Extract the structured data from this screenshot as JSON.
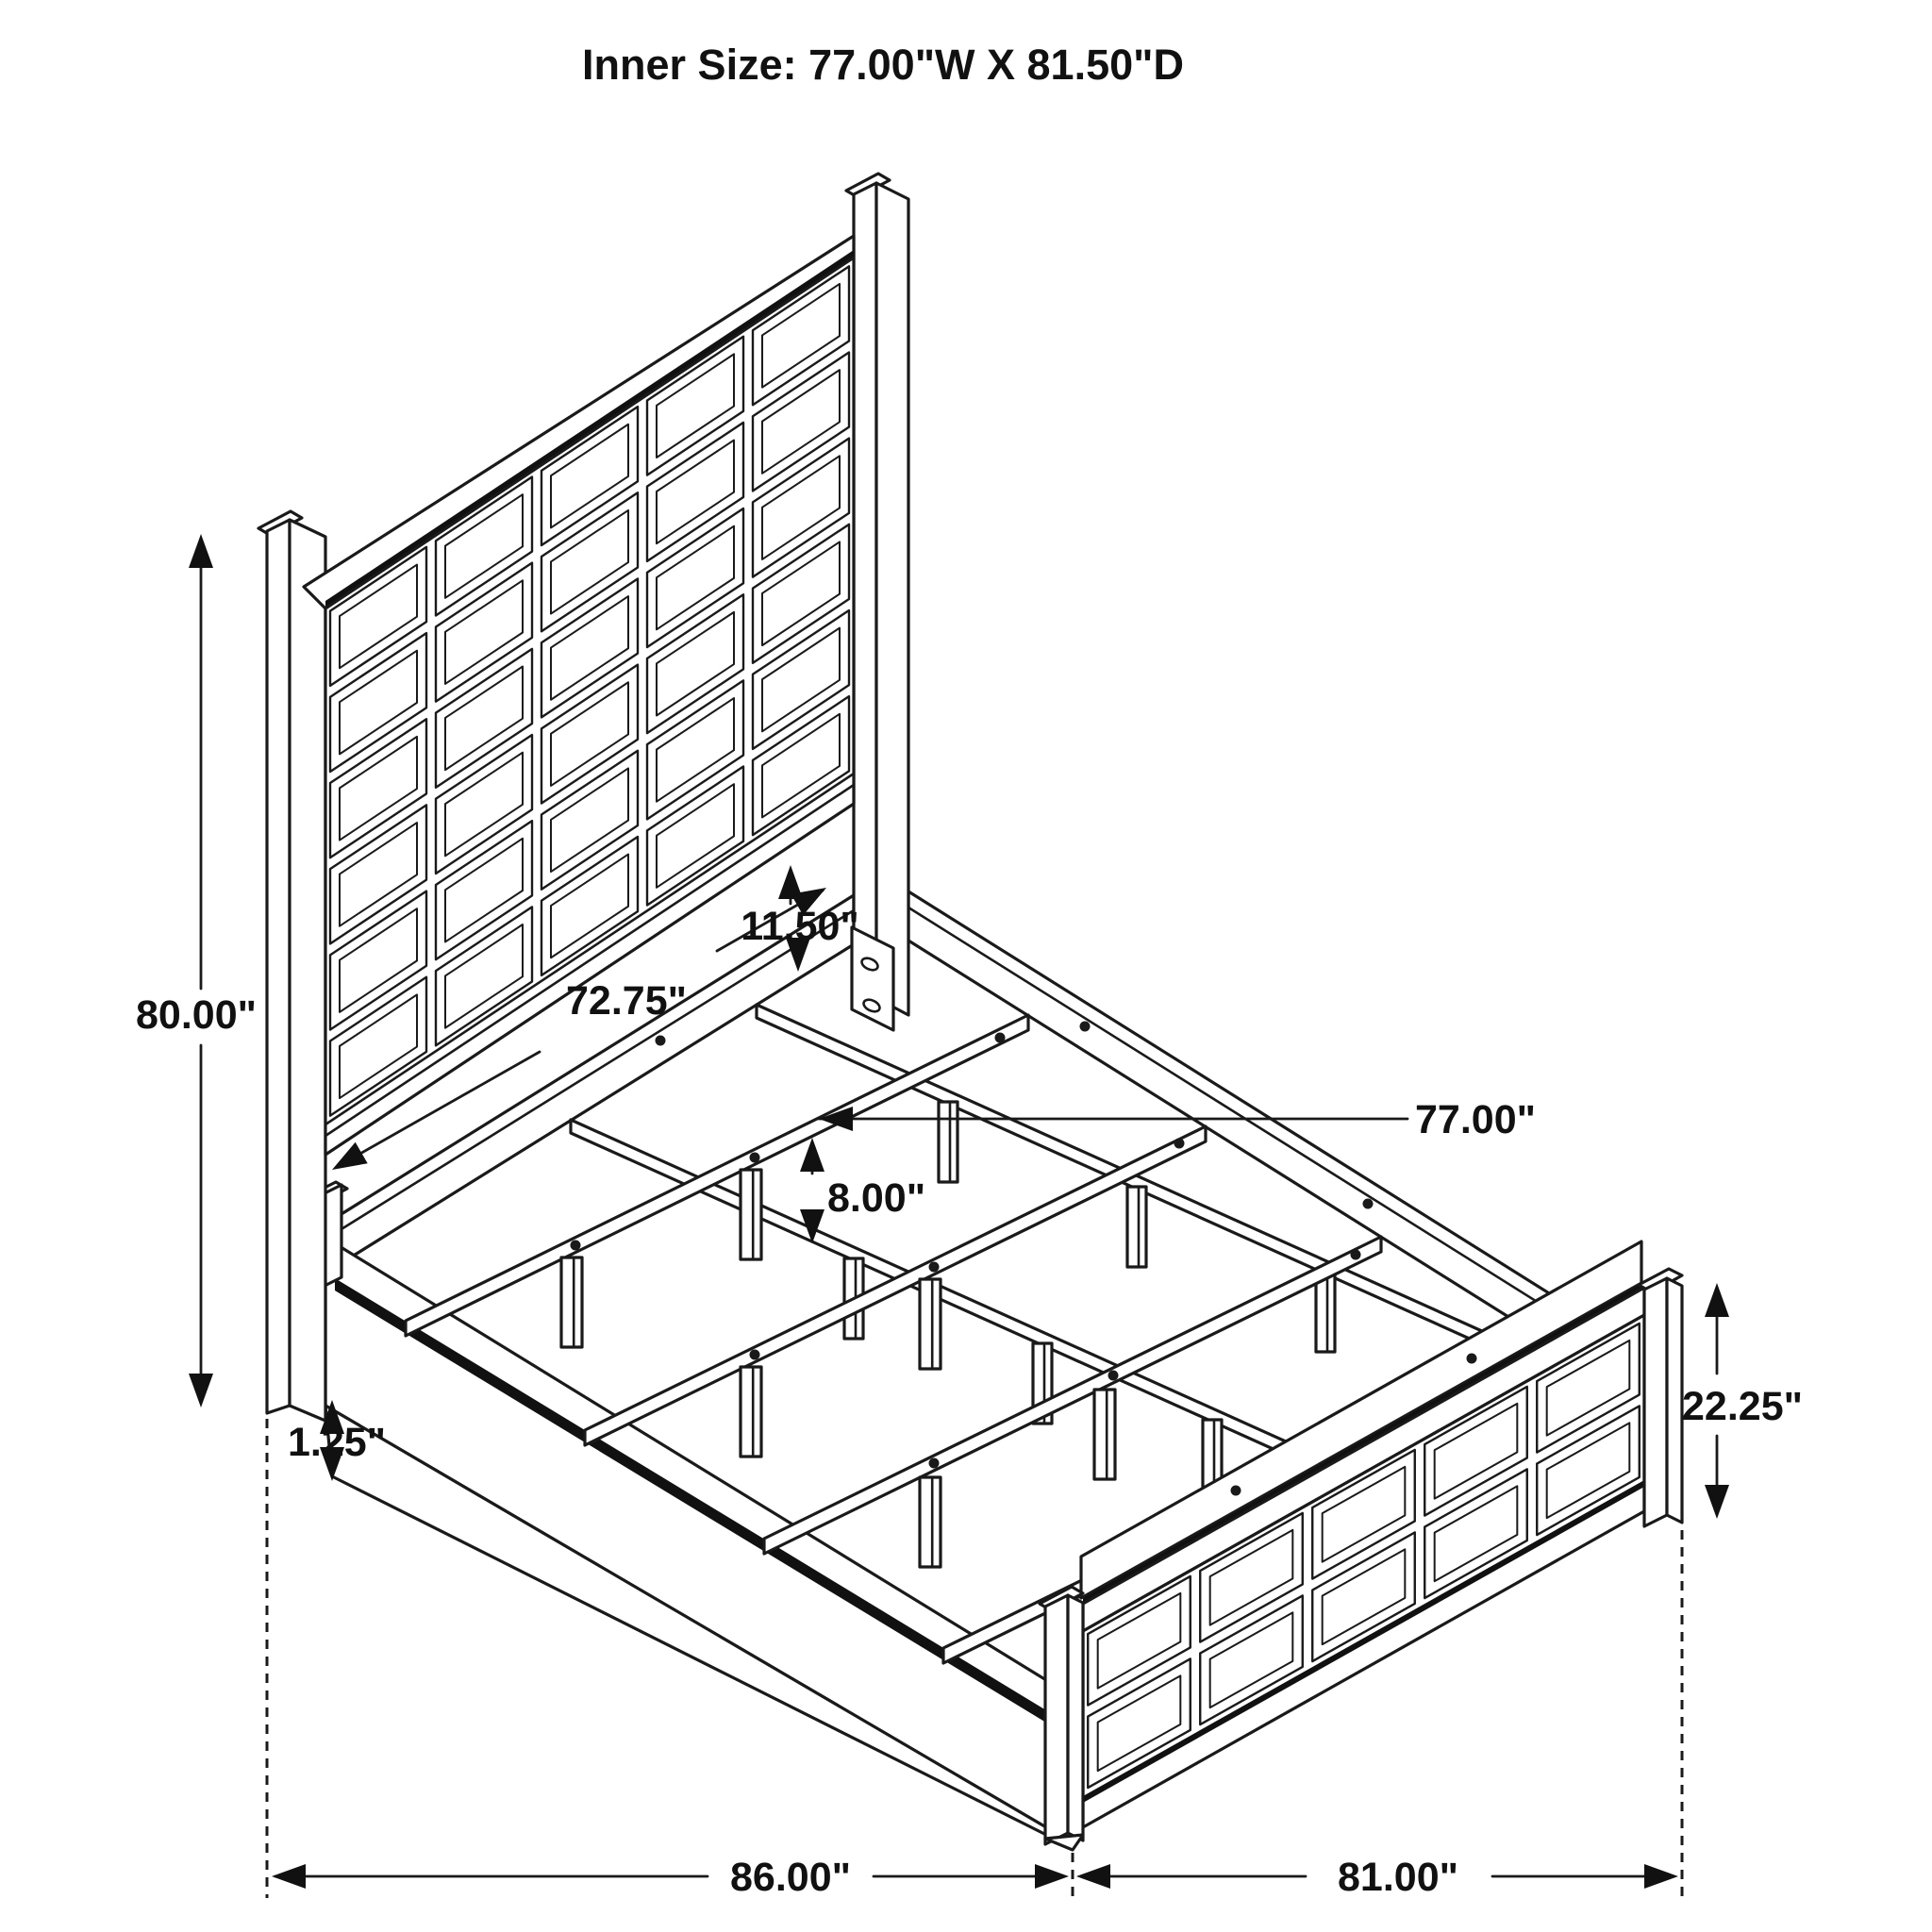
{
  "title": "Inner Size: 77.00\"W X 81.50\"D",
  "colors": {
    "line": "#1a1a1a",
    "background": "#ffffff"
  },
  "dimensions": {
    "headboard_height": {
      "label": "80.00\"",
      "meaning": "headboard overall height"
    },
    "headboard_panel_width": {
      "label": "72.75\"",
      "meaning": "headboard panel width"
    },
    "rail_gap": {
      "label": "11.50\"",
      "meaning": "gap between headboard panel and rail"
    },
    "slat_leg_height": {
      "label": "8.00\"",
      "meaning": "slat support leg height"
    },
    "inner_width": {
      "label": "77.00\"",
      "meaning": "inner width between rails"
    },
    "base_height": {
      "label": "1.25\"",
      "meaning": "side rail base height"
    },
    "footboard_height": {
      "label": "22.25\"",
      "meaning": "footboard height"
    },
    "overall_length": {
      "label": "86.00\"",
      "meaning": "overall length"
    },
    "overall_width": {
      "label": "81.00\"",
      "meaning": "overall width"
    }
  }
}
